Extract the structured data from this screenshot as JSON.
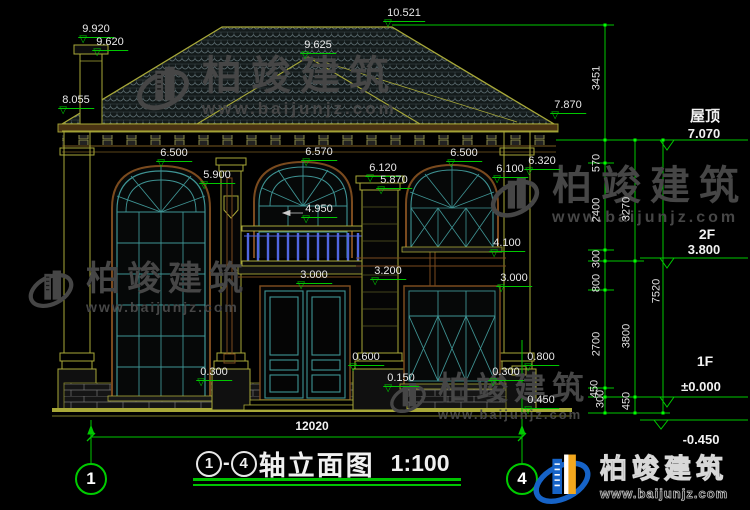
{
  "drawing": {
    "type": "architectural-elevation",
    "scale_note": "1:100"
  },
  "title_block": {
    "axis_start": "1",
    "separator": "-",
    "axis_end": "4",
    "title": "轴立面图",
    "scale": "1:100"
  },
  "symbols": {
    "level_marker": "▽"
  },
  "colors": {
    "background": "#000000",
    "dimension_green": "#00c800",
    "outline_olive": "#a8a838",
    "frame_teal": "#3f9494",
    "baluster_blue": "#5066e0",
    "watermark_gray": "#464646",
    "logo_blue": "#1663c7",
    "logo_orange": "#f2a71d"
  },
  "watermark": {
    "brand": "柏竣建筑",
    "url": "www.baijunjz.com"
  },
  "logo": {
    "brand": "柏竣建筑",
    "url": "www.baijunjz.com"
  },
  "dimensions": [
    {
      "t": "9.920",
      "x": 96,
      "y": 24
    },
    {
      "t": "9.620",
      "x": 110,
      "y": 37
    },
    {
      "t": "10.521",
      "x": 404,
      "y": 8
    },
    {
      "t": "9.625",
      "x": 318,
      "y": 40
    },
    {
      "t": "7.870",
      "x": 568,
      "y": 100
    },
    {
      "t": "8.055",
      "x": 76,
      "y": 95
    },
    {
      "t": "6.500",
      "x": 174,
      "y": 148
    },
    {
      "t": "5.900",
      "x": 217,
      "y": 170
    },
    {
      "t": "6.570",
      "x": 319,
      "y": 147
    },
    {
      "t": "6.120",
      "x": 383,
      "y": 163
    },
    {
      "t": "5.870",
      "x": 394,
      "y": 175
    },
    {
      "t": "6.500",
      "x": 464,
      "y": 148
    },
    {
      "t": "6.320",
      "x": 542,
      "y": 156
    },
    {
      "t": "6.100",
      "x": 510,
      "y": 164
    },
    {
      "t": "4.950",
      "x": 319,
      "y": 204
    },
    {
      "t": "4.100",
      "x": 507,
      "y": 238
    },
    {
      "t": "3.200",
      "x": 388,
      "y": 266
    },
    {
      "t": "3.000",
      "x": 314,
      "y": 270
    },
    {
      "t": "3.000",
      "x": 514,
      "y": 273
    },
    {
      "t": "0.800",
      "x": 541,
      "y": 352
    },
    {
      "t": "0.600",
      "x": 366,
      "y": 352
    },
    {
      "t": "0.150",
      "x": 401,
      "y": 373
    },
    {
      "t": "0.300",
      "x": 214,
      "y": 367
    },
    {
      "t": "0.300",
      "x": 506,
      "y": 367
    },
    {
      "t": "0.450",
      "x": 541,
      "y": 395
    }
  ],
  "vertical_dims": [
    {
      "t": "3451",
      "x": 597,
      "y": 78
    },
    {
      "t": "570",
      "x": 597,
      "y": 163
    },
    {
      "t": "2400",
      "x": 597,
      "y": 210
    },
    {
      "t": "300",
      "x": 597,
      "y": 259
    },
    {
      "t": "800",
      "x": 597,
      "y": 283
    },
    {
      "t": "2700",
      "x": 597,
      "y": 344
    },
    {
      "t": "450",
      "x": 595,
      "y": 389
    },
    {
      "t": "300",
      "x": 601,
      "y": 399
    },
    {
      "t": "3270",
      "x": 627,
      "y": 209
    },
    {
      "t": "3800",
      "x": 627,
      "y": 336
    },
    {
      "t": "450",
      "x": 627,
      "y": 401
    },
    {
      "t": "7520",
      "x": 657,
      "y": 291
    }
  ],
  "levels": [
    {
      "t": "屋顶",
      "x": 705,
      "y": 110,
      "size": 15
    },
    {
      "t": "7.070",
      "x": 704,
      "y": 127
    },
    {
      "t": "2F",
      "x": 707,
      "y": 228,
      "size": 14
    },
    {
      "t": "3.800",
      "x": 704,
      "y": 243
    },
    {
      "t": "1F",
      "x": 705,
      "y": 355,
      "size": 14
    },
    {
      "t": "±0.000",
      "x": 701,
      "y": 380
    },
    {
      "t": "-0.450",
      "x": 701,
      "y": 433
    },
    {
      "t": "12020",
      "x": 312,
      "y": 420,
      "size": 12
    }
  ]
}
